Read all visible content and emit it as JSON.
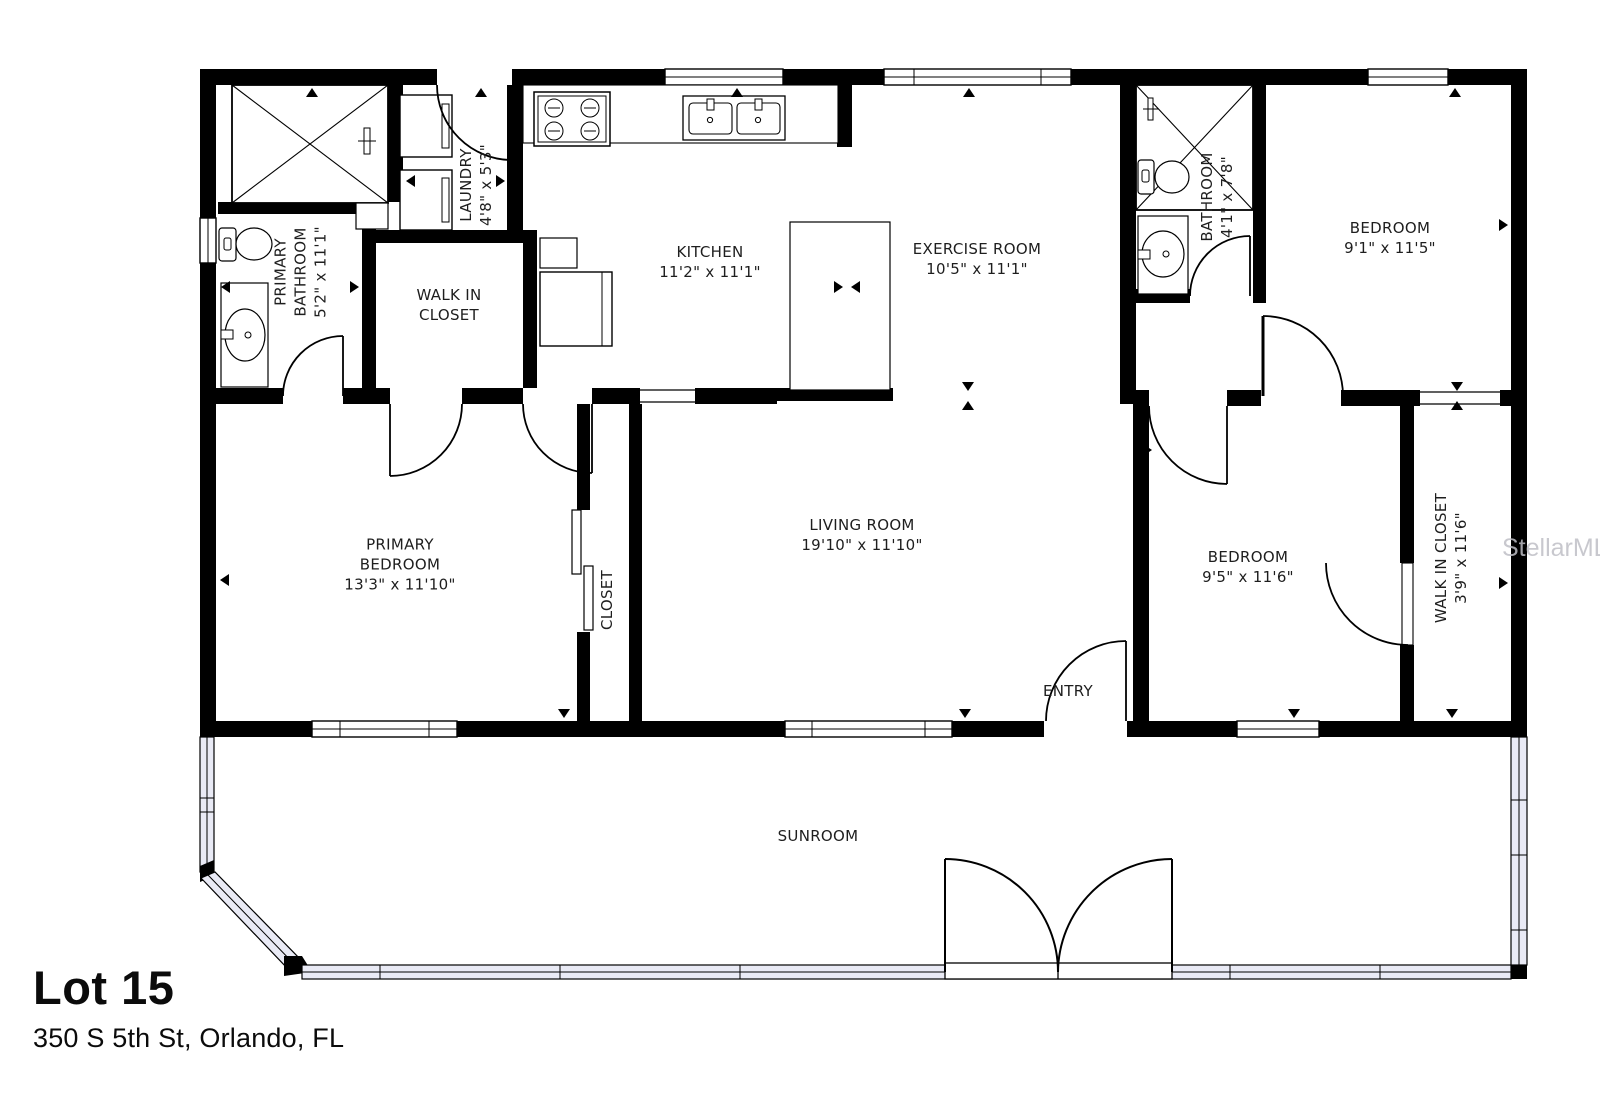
{
  "page": {
    "title": "Lot 15",
    "address": "350 S 5th St, Orlando, FL",
    "watermark": "StellarMLS"
  },
  "rooms": {
    "primary_bathroom": {
      "name": "PRIMARY BATHROOM",
      "dims": "5'2\" x 11'1\""
    },
    "laundry": {
      "name": "LAUNDRY",
      "dims": "4'8\" x 5'3\""
    },
    "walk_in_closet": {
      "name": "WALK IN CLOSET"
    },
    "kitchen": {
      "name": "KITCHEN",
      "dims": "11'2\" x 11'1\""
    },
    "exercise_room": {
      "name": "EXERCISE ROOM",
      "dims": "10'5\" x 11'1\""
    },
    "bathroom": {
      "name": "BATHROOM",
      "dims": "4'1\" x 7'8\""
    },
    "bedroom_ne": {
      "name": "BEDROOM",
      "dims": "9'1\" x 11'5\""
    },
    "primary_bedroom": {
      "name": "PRIMARY BEDROOM",
      "dims": "13'3\" x 11'10\""
    },
    "closet": {
      "name": "CLOSET"
    },
    "living_room": {
      "name": "LIVING ROOM",
      "dims": "19'10\" x 11'10\""
    },
    "bedroom_se": {
      "name": "BEDROOM",
      "dims": "9'5\" x 11'6\""
    },
    "walk_in_closet_2": {
      "name": "WALK IN CLOSET",
      "dims": "3'9\" x 11'6\""
    },
    "entry": {
      "name": "ENTRY"
    },
    "sunroom": {
      "name": "SUNROOM"
    }
  }
}
